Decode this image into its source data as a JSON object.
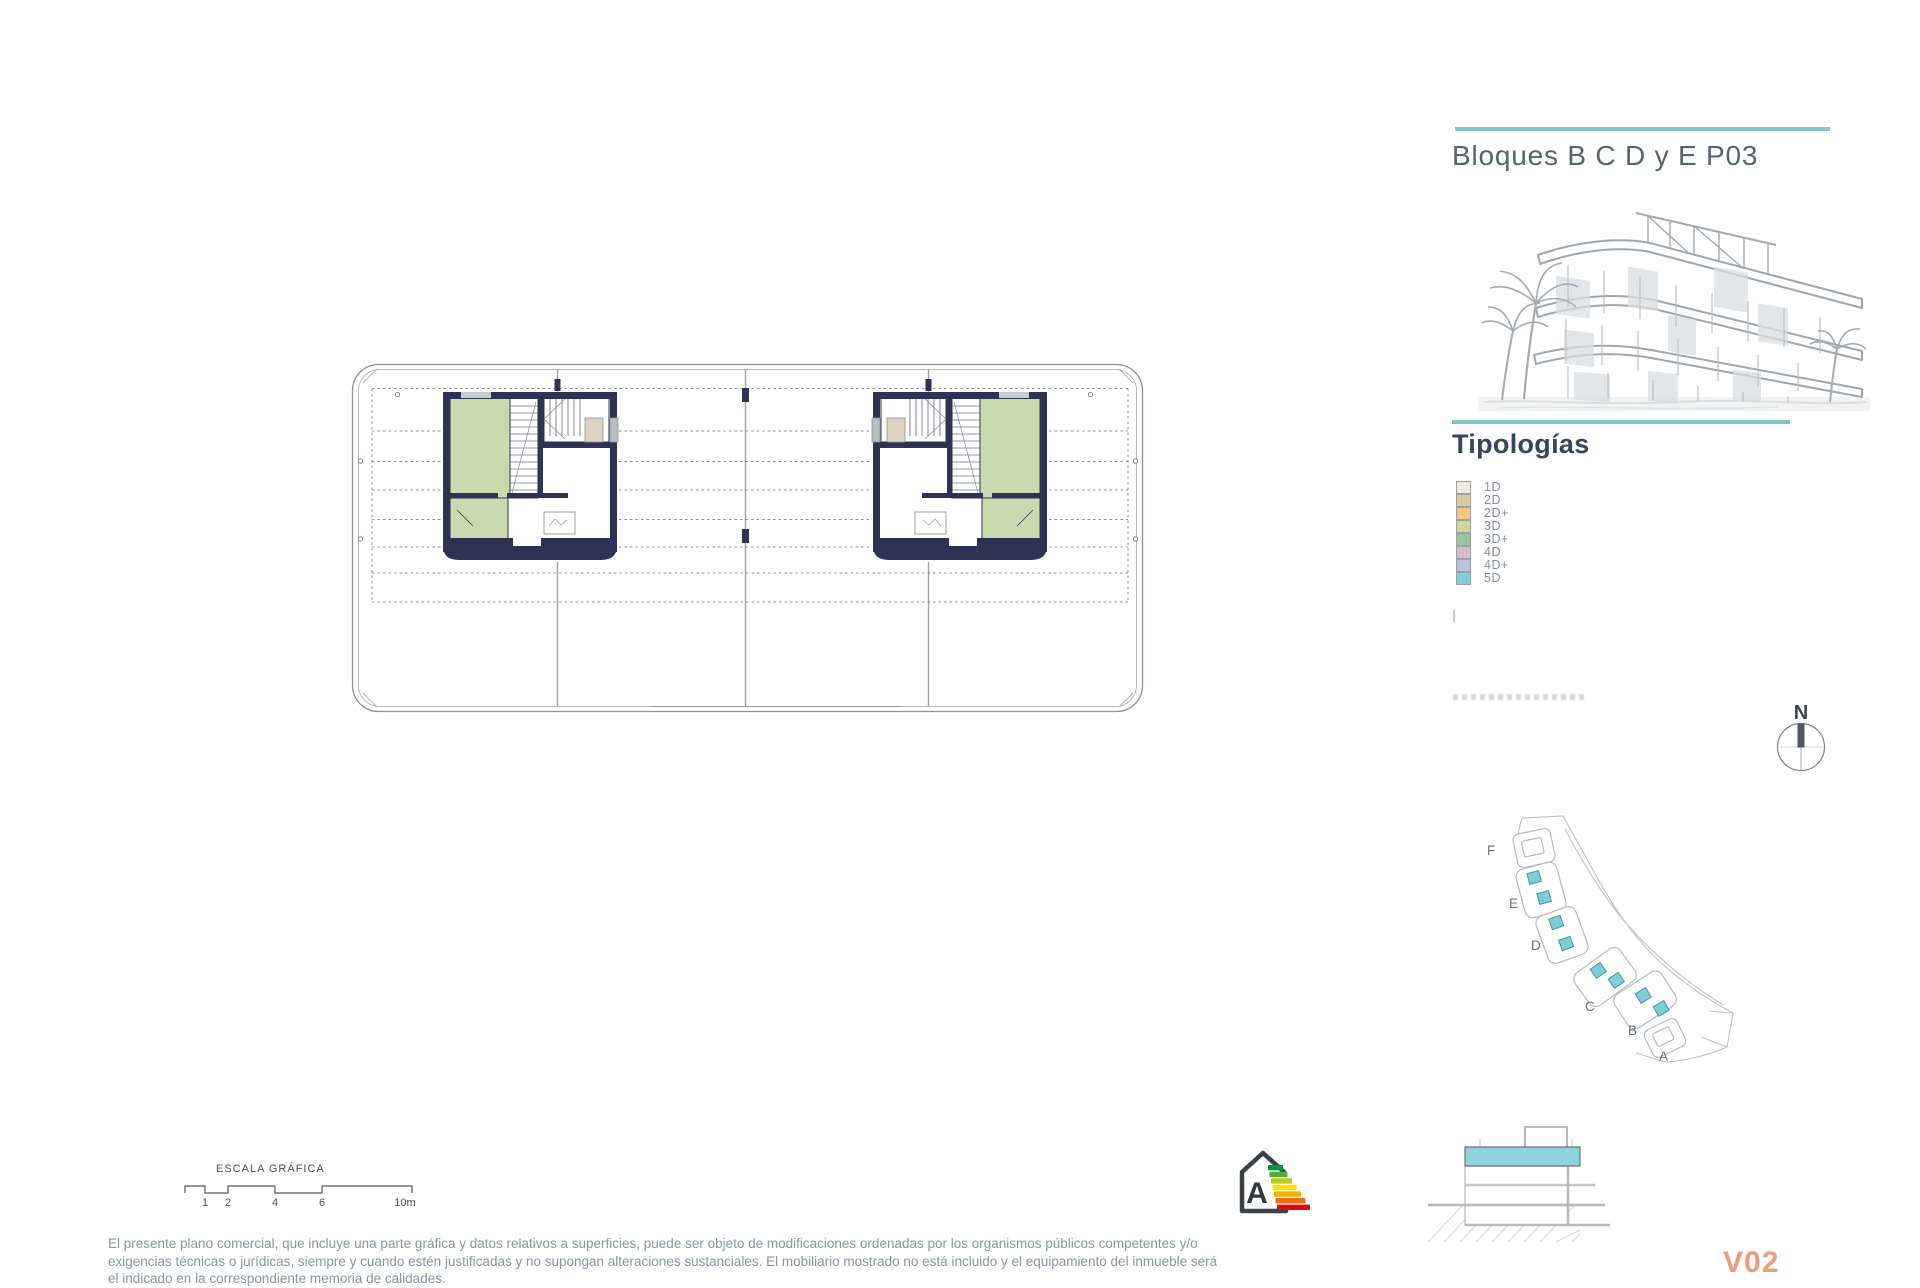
{
  "header": {
    "title": "Bloques B C D y E P03"
  },
  "typologies": {
    "heading": "Tipologías",
    "items": [
      {
        "label": "1D",
        "color": "#f0ebd7"
      },
      {
        "label": "2D",
        "color": "#d8c9a4"
      },
      {
        "label": "2D+",
        "color": "#f4c57e"
      },
      {
        "label": "3D",
        "color": "#ccd79c"
      },
      {
        "label": "3D+",
        "color": "#9ac4a1"
      },
      {
        "label": "4D",
        "color": "#d7b9c8"
      },
      {
        "label": "4D+",
        "color": "#bfc0df"
      },
      {
        "label": "5D",
        "color": "#7ed0d8"
      }
    ]
  },
  "compass": {
    "label": "N"
  },
  "site_plan": {
    "block_labels": [
      "F",
      "E",
      "D",
      "C",
      "B",
      "A"
    ]
  },
  "scale_bar": {
    "title": "ESCALA GRÁFICA",
    "ticks": [
      "1",
      "2",
      "4",
      "6",
      "10m"
    ]
  },
  "energy_label": {
    "grade": "A",
    "bar_colors": [
      "#009640",
      "#4caf32",
      "#b5cc1d",
      "#ffe000",
      "#f9b000",
      "#ed6e0c",
      "#e30613"
    ]
  },
  "disclaimer_lines": [
    "El presente plano comercial, que incluye una parte gráfica y datos relativos a superficies, puede ser objeto de modificaciones ordenadas por los organismos públicos competentes y/o",
    "exigencias técnicas o jurídicas, siempre y cuando estén justificadas y no supongan alteraciones sustanciales. El mobiliario mostrado no está incluido y el equipamiento del inmueble será",
    "el indicado en la correspondiente memoria de calidades."
  ],
  "version": "V02",
  "colors": {
    "accent_teal": "#7ec7d0",
    "wall_navy": "#2f3254",
    "room_green": "#cbdaae",
    "closet_beige": "#ded3c0",
    "pool_teal": "#7fccd6",
    "version_salmon": "#e99d7c",
    "title_text": "#54646f"
  }
}
